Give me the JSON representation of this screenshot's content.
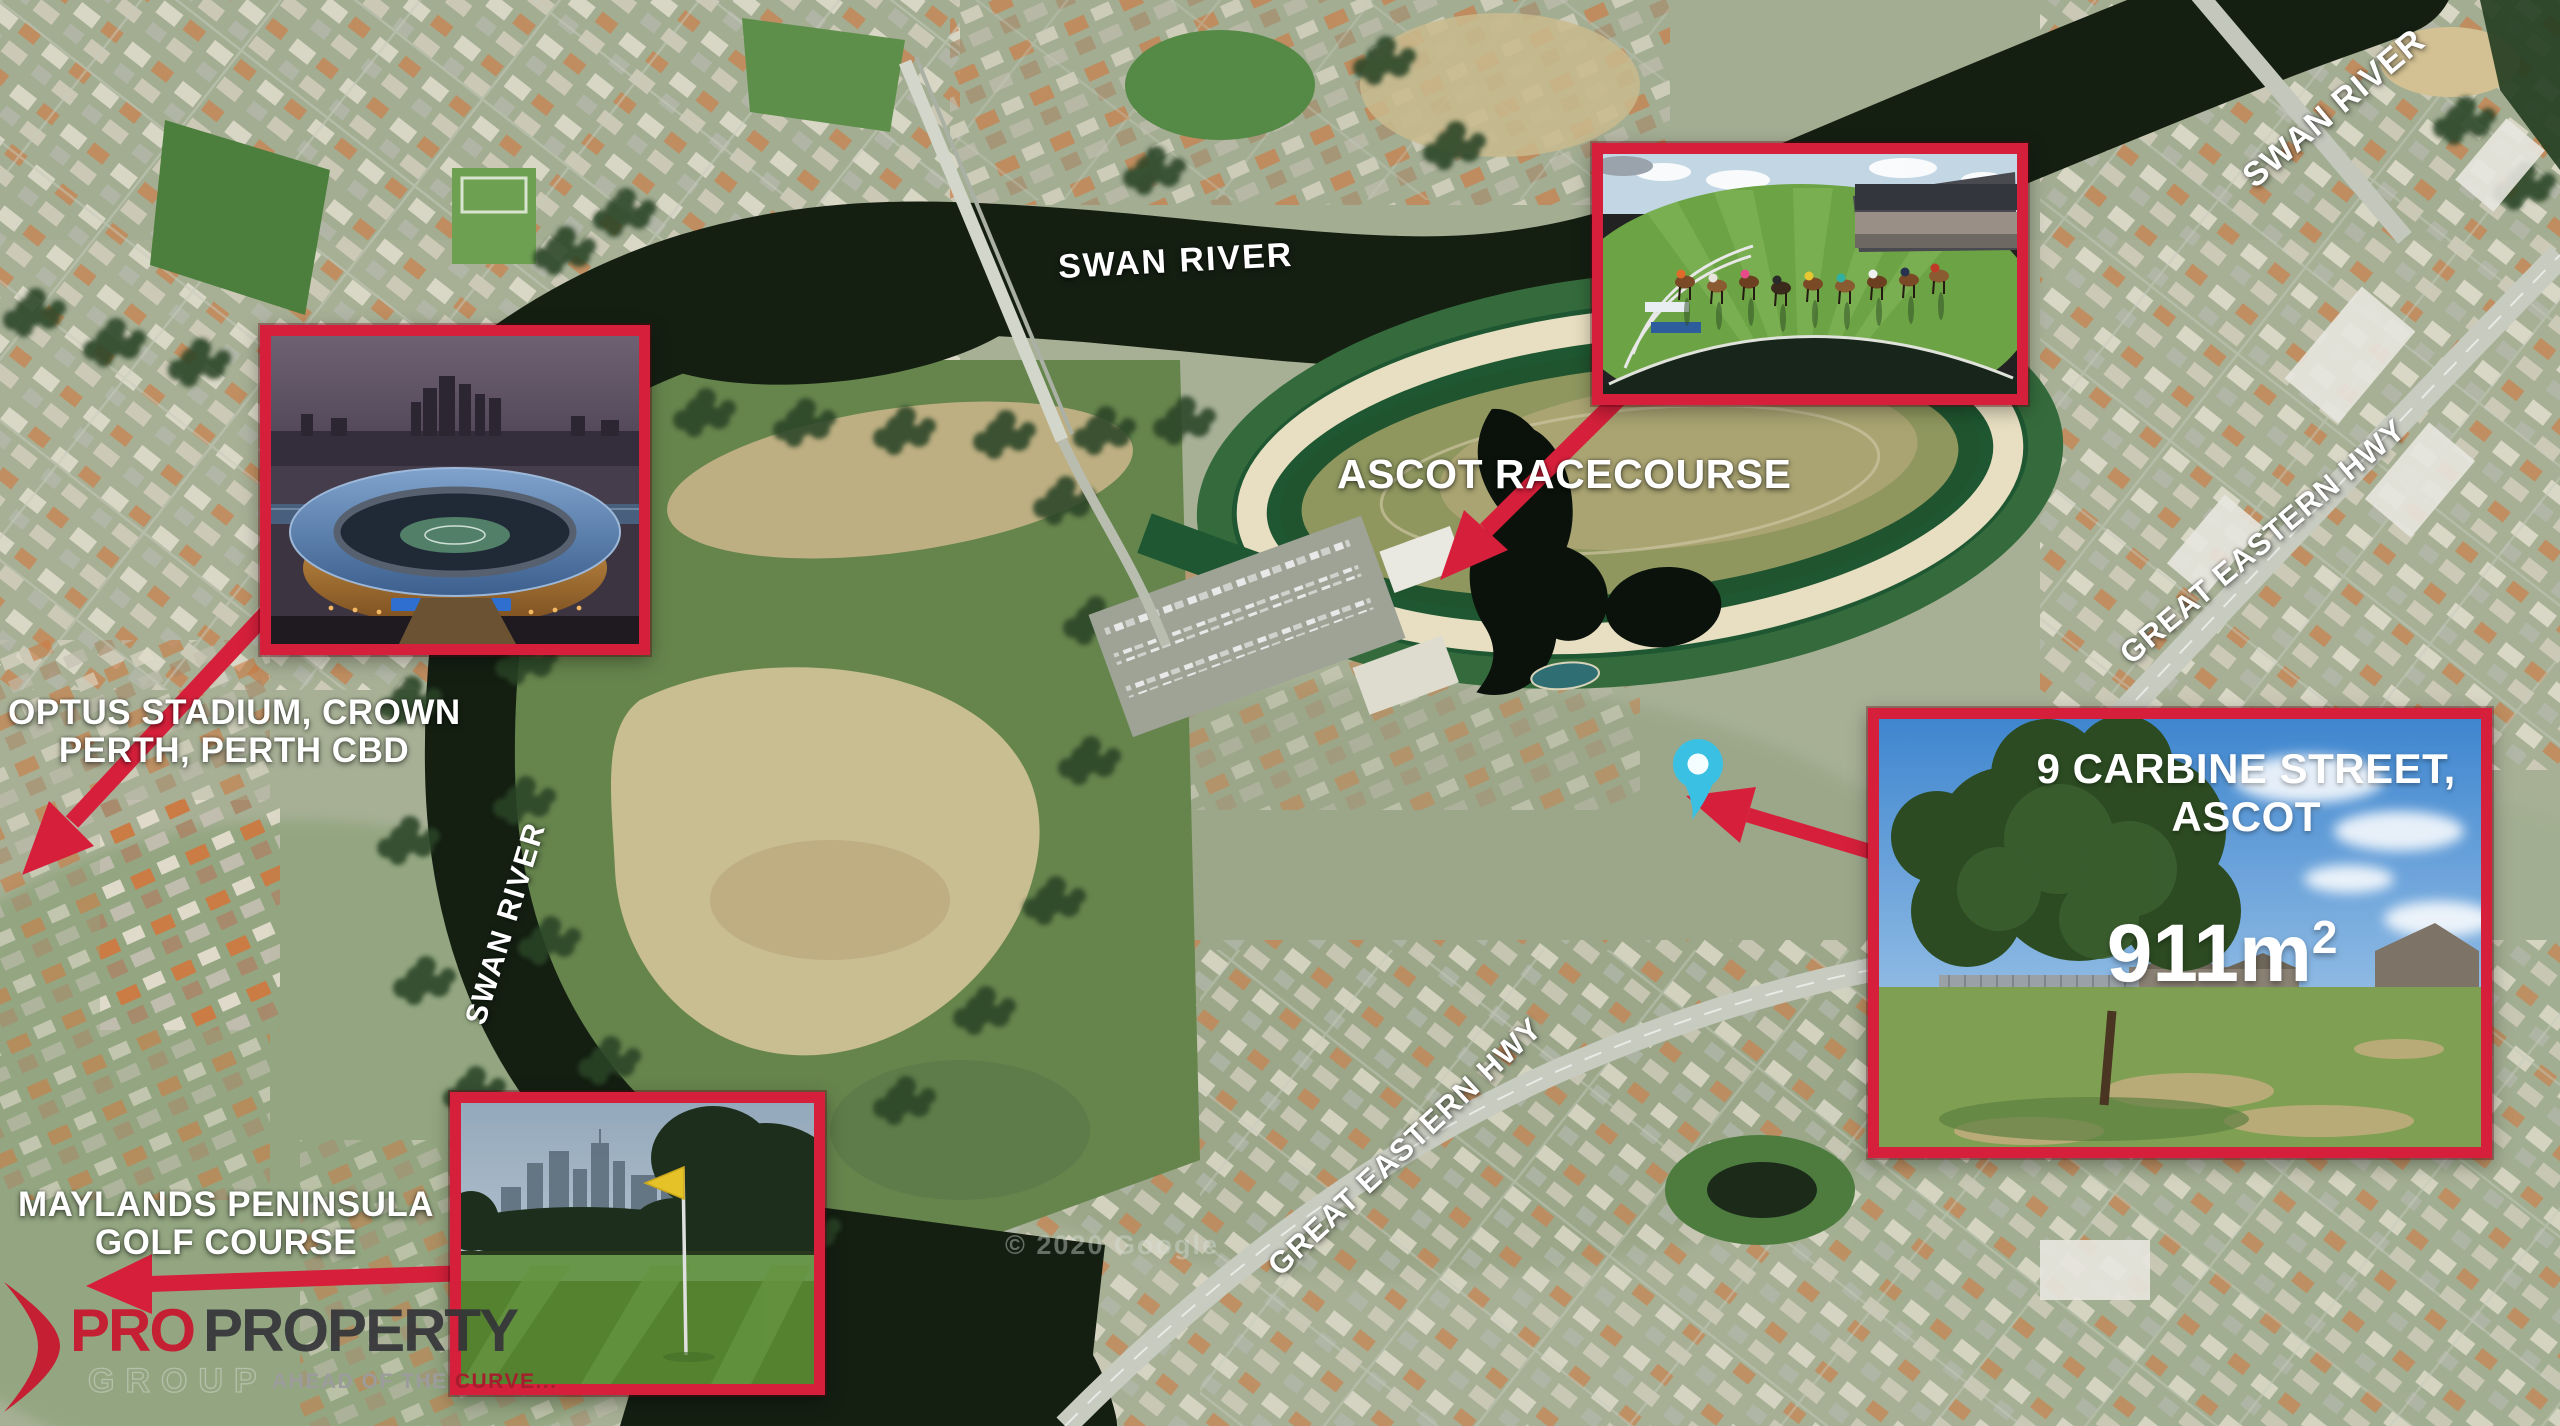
{
  "map_labels": {
    "swan_river_center": "SWAN RIVER",
    "swan_river_west": "SWAN RIVER",
    "swan_river_northeast": "SWAN RIVER",
    "ascot_racecourse": "ASCOT RACECOURSE",
    "great_eastern_hwy_northeast": "GREAT EASTERN HWY",
    "great_eastern_hwy_south": "GREAT EASTERN HWY",
    "optus_line1": "OPTUS STADIUM, CROWN",
    "optus_line2": "PERTH, PERTH CBD",
    "maylands_line1": "MAYLANDS PENINSULA",
    "maylands_line2": "GOLF COURSE"
  },
  "property_inset": {
    "address_line1": "9 CARBINE STREET,",
    "address_line2": "ASCOT",
    "area_value": "911m",
    "area_exponent": "2"
  },
  "logo": {
    "pro": "PRO",
    "property": "PROPERTY",
    "group": "GROUP",
    "tagline_gray": "AHEAD OF THE ",
    "tagline_red": "CURVE..."
  },
  "watermark": "© 2020 Google",
  "colors": {
    "accent_red": "#d6203b",
    "pin_teal": "#3ac0e2",
    "label_white": "#ffffff"
  }
}
